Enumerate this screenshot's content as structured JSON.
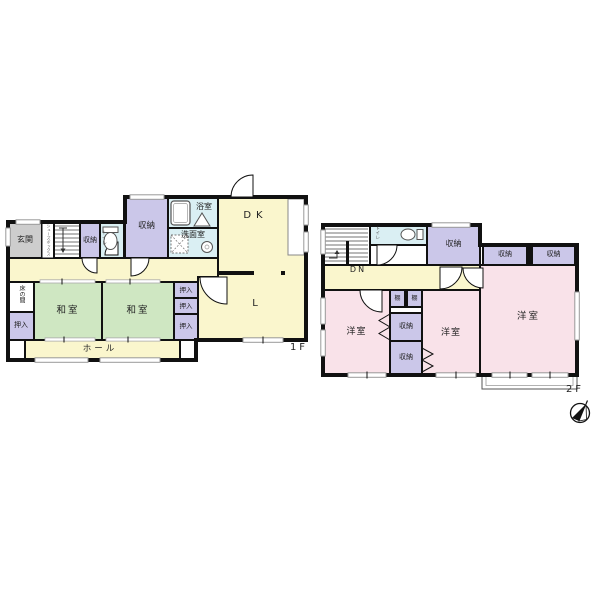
{
  "f1": {
    "floor_label": "1F",
    "genkan": "玄関",
    "shoebox": "シューズボックス",
    "storage_small": "収納",
    "toilet": "トイレ",
    "storage_big": "収納",
    "bath": "浴室",
    "washroom": "洗面室",
    "dk": "DK",
    "living": "L",
    "tokonoma": "床の間",
    "oshiire_sw": "押入",
    "washitsu_w": "和室",
    "washitsu_e": "和室",
    "oshiire_ne": "押入",
    "oshiire_e1": "押入",
    "oshiire_e2": "押入",
    "hall": "ホール"
  },
  "f2": {
    "floor_label": "2F",
    "dn": "DN",
    "toilet": "トイレ",
    "storage_top": "収納",
    "storage_ne1": "収納",
    "storage_ne2": "収納",
    "yoshitsu_w": "洋室",
    "yoshitsu_c": "洋室",
    "yoshitsu_e": "洋室",
    "tana1": "棚",
    "tana2": "棚",
    "storage_c1": "収納",
    "storage_c2": "収納"
  },
  "colors": {
    "wall": "#111111",
    "room_yellow": "#faf6cd",
    "room_green": "#cfe7c2",
    "closet_purple": "#cbc7e9",
    "wet_cyan": "#daeff3",
    "room_pink": "#f9e2e9",
    "entry_gray": "#cdcdcd",
    "white": "#ffffff"
  }
}
